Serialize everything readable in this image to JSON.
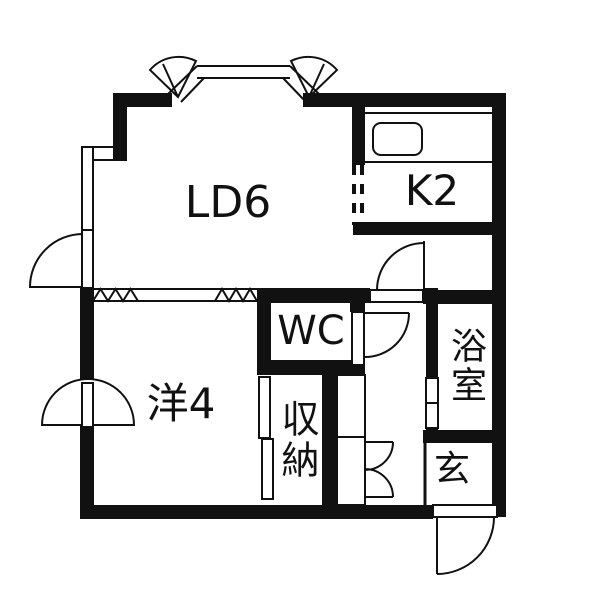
{
  "floorplan": {
    "background_color": "#ffffff",
    "wall_color": "#111111",
    "rooms": [
      {
        "name": "living-dining",
        "label": "LD6"
      },
      {
        "name": "kitchen",
        "label": "K2"
      },
      {
        "name": "toilet",
        "label": "WC"
      },
      {
        "name": "western-room",
        "label": "洋4"
      },
      {
        "name": "storage",
        "label": "収納"
      },
      {
        "name": "bathroom",
        "label": "浴室"
      },
      {
        "name": "entrance",
        "label": "玄"
      }
    ]
  }
}
